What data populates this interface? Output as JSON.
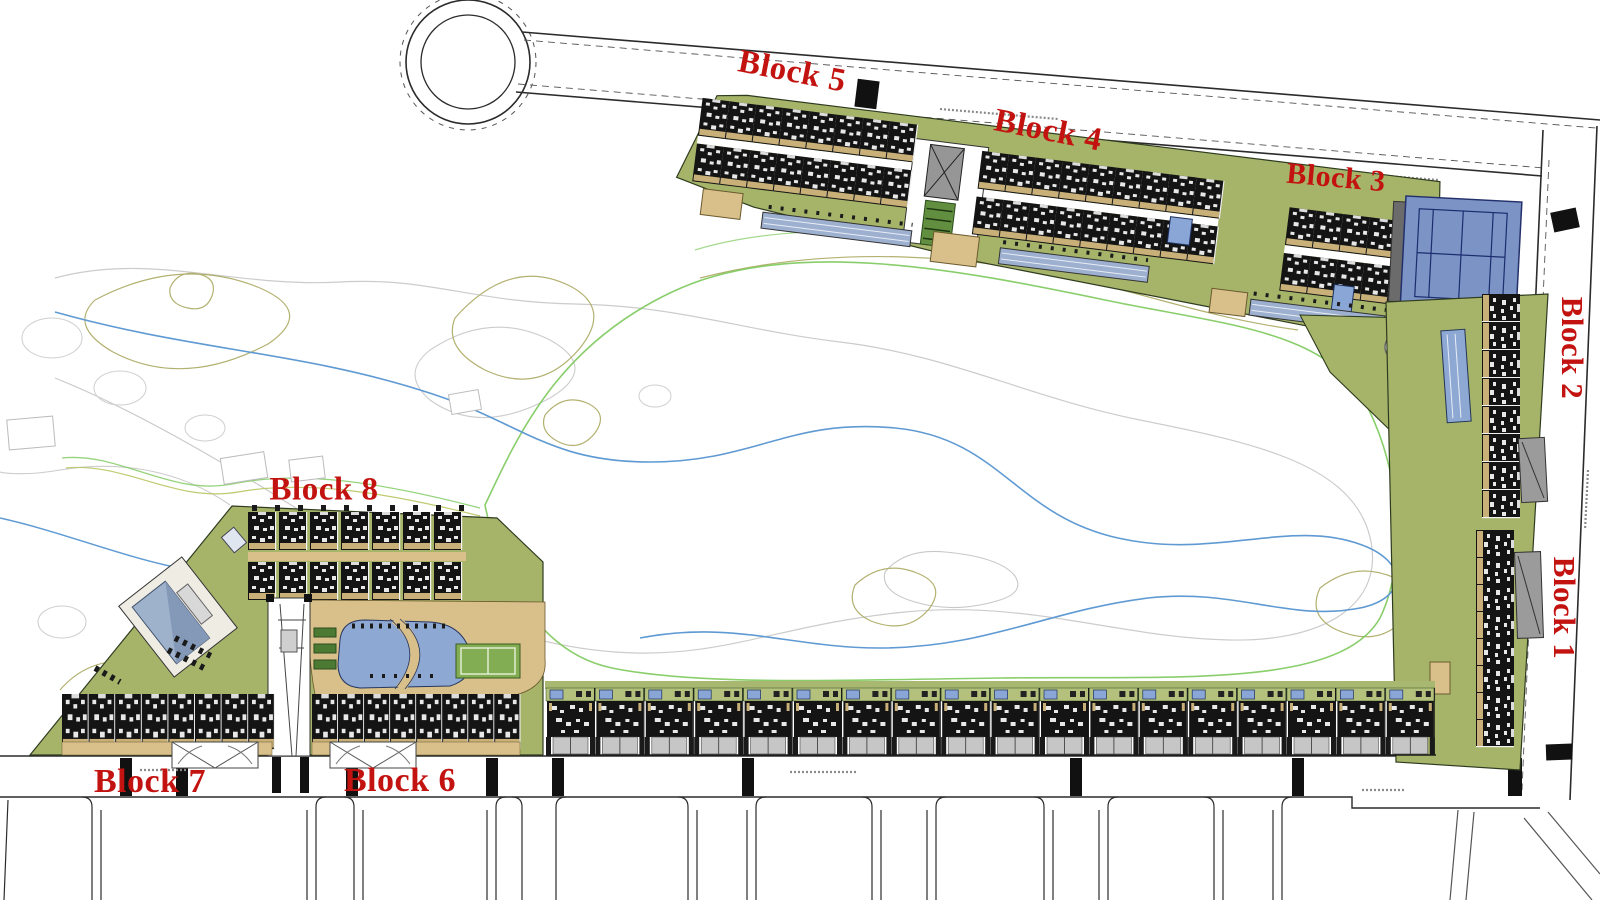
{
  "labels": {
    "block1": "Block 1",
    "block2": "Block 2",
    "block3": "Block 3",
    "block4": "Block 4",
    "block5": "Block 5",
    "block6": "Block 6",
    "block7": "Block 7",
    "block8": "Block 8"
  },
  "unit_counts": {
    "villa_row": 18,
    "block8_per_row": 7,
    "block8_rows": 2,
    "block7_row": 8,
    "block6_row": 8,
    "block5_per_row": 8,
    "block4_per_row": 9,
    "block3_per_row": 5,
    "block2_column": 8,
    "block1_column": 8
  },
  "features": [
    "cul-de-sac",
    "tennis-court",
    "swimming-pool",
    "lap-pools",
    "clubhouse",
    "sport-court",
    "golf-course",
    "roundabout",
    "walkway-obelisk",
    "villa-row",
    "crosswalks",
    "parking-ramps"
  ],
  "colors": {
    "label_red": "#c31310",
    "parcel_green": "#a6b46a",
    "garden_green": "#b3c17c",
    "sand_tan": "#d9c08b",
    "pool_blue": "#8ea8d4",
    "tennis_blue": "#7b94c5",
    "court_line_navy": "#1c2c6e",
    "sport_court_green": "#83ad52",
    "building_dark": "#141414",
    "drive_gray": "#c6c6c6",
    "ramp_gray": "#969696",
    "roof_gray_blue": "#9fb2cc",
    "contour_gray": "#cccccc",
    "contour_olive": "#b3b170",
    "contour_green": "#7cc95b",
    "contour_blue": "#5f9ad3",
    "road_line": "#2b2b2b"
  }
}
